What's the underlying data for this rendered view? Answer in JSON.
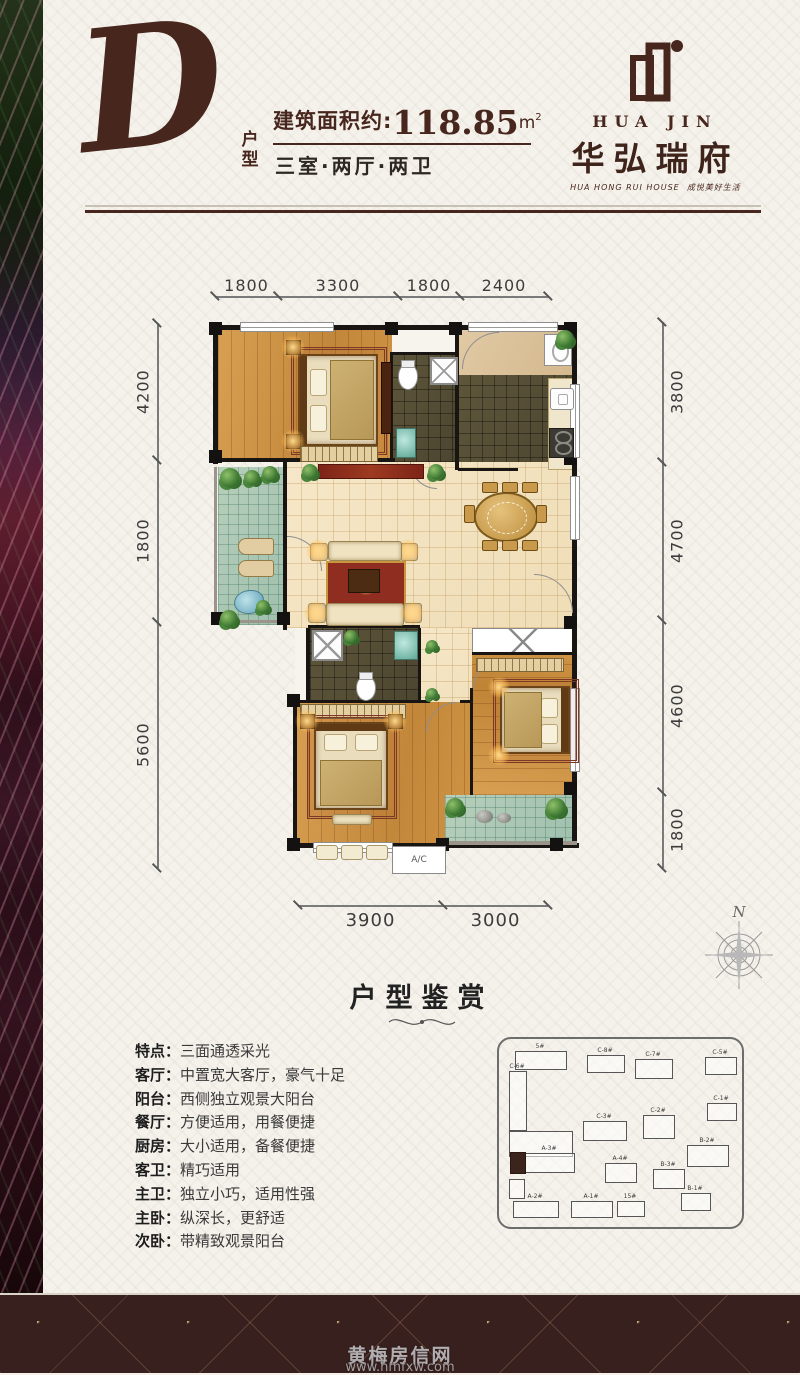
{
  "page": {
    "bg": "#f5f2ec",
    "accent": "#47261d",
    "footer_bg": "#37201d"
  },
  "header": {
    "type_letter": "D",
    "type_label": "户型",
    "area_prefix": "建筑面积约:",
    "area_value": "118.85",
    "area_unit": "m",
    "area_sup": "2",
    "layout_line": "三室·两厅·两卫"
  },
  "logo": {
    "latin": "HUA JIN",
    "brand": "华弘瑞府",
    "tagline_en": "HUA HONG RUI HOUSE",
    "tagline_cn": "成悦美好生活"
  },
  "floorplan": {
    "dims": {
      "top": [
        "1800",
        "3300",
        "1800",
        "2400"
      ],
      "left": [
        "4200",
        "1800",
        "5600"
      ],
      "right": [
        "3800",
        "4700",
        "4600",
        "1800"
      ],
      "bottom": [
        "3900",
        "3000"
      ]
    },
    "ac_label": "A/C",
    "compass": "N"
  },
  "section": {
    "title": "户型鉴赏",
    "flourish": "——— ❧ ———"
  },
  "ui": {
    "colon": "："
  },
  "features": [
    {
      "label": "特点",
      "text": "三面通透采光"
    },
    {
      "label": "客厅",
      "text": "中置宽大客厅，豪气十足"
    },
    {
      "label": "阳台",
      "text": "西侧独立观景大阳台"
    },
    {
      "label": "餐厅",
      "text": "方便适用，用餐便捷"
    },
    {
      "label": "厨房",
      "text": "大小适用，备餐便捷"
    },
    {
      "label": "客卫",
      "text": "精巧适用"
    },
    {
      "label": "主卫",
      "text": "独立小巧，适用性强"
    },
    {
      "label": "主卧",
      "text": "纵深长，更舒适"
    },
    {
      "label": "次卧",
      "text": "带精致观景阳台"
    }
  ],
  "siteplan": {
    "buildings": [
      {
        "label": "5#",
        "x": 16,
        "y": 12,
        "w": 50,
        "h": 17,
        "dark": false
      },
      {
        "label": "C-8#",
        "x": 88,
        "y": 16,
        "w": 36,
        "h": 16,
        "dark": false
      },
      {
        "label": "C-7#",
        "x": 136,
        "y": 20,
        "w": 36,
        "h": 18,
        "dark": false
      },
      {
        "label": "C-5#",
        "x": 206,
        "y": 18,
        "w": 30,
        "h": 16,
        "dark": false
      },
      {
        "label": "C-6#",
        "x": 10,
        "y": 32,
        "w": 16,
        "h": 58,
        "dark": false
      },
      {
        "label": "",
        "x": 10,
        "y": 92,
        "w": 62,
        "h": 24,
        "dark": false
      },
      {
        "label": "C-3#",
        "x": 84,
        "y": 82,
        "w": 42,
        "h": 18,
        "dark": false
      },
      {
        "label": "C-2#",
        "x": 144,
        "y": 76,
        "w": 30,
        "h": 22,
        "dark": false
      },
      {
        "label": "C-1#",
        "x": 208,
        "y": 64,
        "w": 28,
        "h": 16,
        "dark": false
      },
      {
        "label": "B-2#",
        "x": 188,
        "y": 106,
        "w": 40,
        "h": 20,
        "dark": false
      },
      {
        "label": "A-3#",
        "x": 26,
        "y": 114,
        "w": 48,
        "h": 18,
        "dark": false
      },
      {
        "label": "",
        "x": 11,
        "y": 113,
        "w": 14,
        "h": 20,
        "dark": true
      },
      {
        "label": "",
        "x": 10,
        "y": 140,
        "w": 14,
        "h": 18,
        "dark": false
      },
      {
        "label": "A-4#",
        "x": 106,
        "y": 124,
        "w": 30,
        "h": 18,
        "dark": false
      },
      {
        "label": "B-3#",
        "x": 154,
        "y": 130,
        "w": 30,
        "h": 18,
        "dark": false
      },
      {
        "label": "A-2#",
        "x": 14,
        "y": 162,
        "w": 44,
        "h": 15,
        "dark": false
      },
      {
        "label": "A-1#",
        "x": 72,
        "y": 162,
        "w": 40,
        "h": 15,
        "dark": false
      },
      {
        "label": "15#",
        "x": 118,
        "y": 162,
        "w": 26,
        "h": 14,
        "dark": false
      },
      {
        "label": "B-1#",
        "x": 182,
        "y": 154,
        "w": 28,
        "h": 16,
        "dark": false
      }
    ]
  },
  "watermark": {
    "line1": "黄梅房信网",
    "line2": "www.hmfxw.com"
  }
}
